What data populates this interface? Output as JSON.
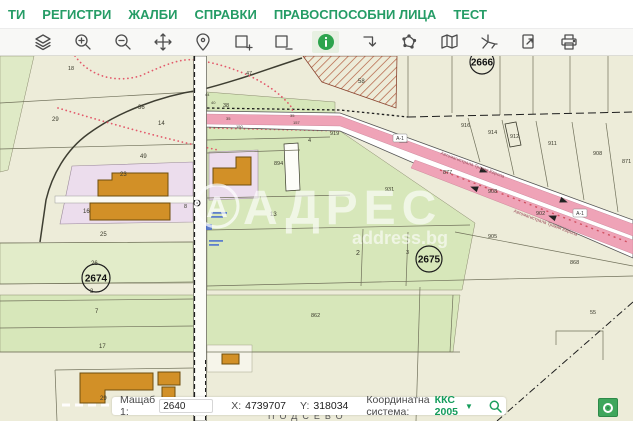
{
  "menu": {
    "items": [
      {
        "label": "ТИ"
      },
      {
        "label": "РЕГИСТРИ"
      },
      {
        "label": "ЖАЛБИ"
      },
      {
        "label": "СПРАВКИ"
      },
      {
        "label": "ПРАВОСПОСОБНИ ЛИЦА"
      },
      {
        "label": "ТЕСТ"
      }
    ]
  },
  "toolbar": {
    "icons": [
      "layers",
      "zoom-in",
      "zoom-out",
      "pan",
      "locate",
      "select-area-add",
      "select-area-subtract",
      "info",
      "measure-arrow",
      "polygon-select",
      "map-sheets",
      "snap-intersection",
      "export-document",
      "print"
    ],
    "active_tool": "info"
  },
  "map": {
    "watermark": {
      "logo_letter": "А",
      "brand": "АДРЕС",
      "site": "address.bg"
    },
    "highway": {
      "name": "Автомагистрала Тракия Европа",
      "shield": "А-1"
    },
    "area_label": "ПОДСЕВО",
    "circles": [
      {
        "text": "2666",
        "x": 482,
        "y": 6,
        "r": 12
      },
      {
        "text": "2674",
        "x": 96,
        "y": 222,
        "r": 14
      },
      {
        "text": "2675",
        "x": 429,
        "y": 203,
        "r": 13
      }
    ],
    "labels": [
      {
        "t": "18",
        "x": 68,
        "y": 14
      },
      {
        "t": "29",
        "x": 52,
        "y": 65,
        "s": 6
      },
      {
        "t": "36",
        "x": 138,
        "y": 53,
        "s": 6
      },
      {
        "t": "14",
        "x": 158,
        "y": 69,
        "s": 6
      },
      {
        "t": "49",
        "x": 140,
        "y": 102,
        "s": 6
      },
      {
        "t": "23",
        "x": 120,
        "y": 120,
        "s": 6
      },
      {
        "t": "16",
        "x": 83,
        "y": 157,
        "s": 6
      },
      {
        "t": "8",
        "x": 184,
        "y": 152
      },
      {
        "t": "25",
        "x": 100,
        "y": 180,
        "s": 6
      },
      {
        "t": "26",
        "x": 91,
        "y": 209,
        "s": 6
      },
      {
        "t": "3",
        "x": 90,
        "y": 237,
        "s": 6
      },
      {
        "t": "7",
        "x": 95,
        "y": 257,
        "s": 6
      },
      {
        "t": "17",
        "x": 99,
        "y": 292,
        "s": 6
      },
      {
        "t": "29",
        "x": 100,
        "y": 344,
        "s": 6
      },
      {
        "t": "47",
        "x": 246,
        "y": 19
      },
      {
        "t": "38",
        "x": 223,
        "y": 51
      },
      {
        "t": "44",
        "x": 205,
        "y": 40,
        "s": 4
      },
      {
        "t": "40",
        "x": 211,
        "y": 48,
        "s": 4
      },
      {
        "t": "35",
        "x": 226,
        "y": 64,
        "s": 4
      },
      {
        "t": "35",
        "x": 290,
        "y": 61,
        "s": 4
      },
      {
        "t": "150",
        "x": 236,
        "y": 72,
        "s": 4
      },
      {
        "t": "157",
        "x": 293,
        "y": 68,
        "s": 4
      },
      {
        "t": "919",
        "x": 330,
        "y": 79
      },
      {
        "t": "894",
        "x": 274,
        "y": 109
      },
      {
        "t": "4",
        "x": 308,
        "y": 86
      },
      {
        "t": "13",
        "x": 270,
        "y": 160,
        "s": 6
      },
      {
        "t": "2",
        "x": 356,
        "y": 199,
        "s": 7
      },
      {
        "t": "931",
        "x": 385,
        "y": 135
      },
      {
        "t": "58",
        "x": 358,
        "y": 27,
        "s": 6
      },
      {
        "t": "916",
        "x": 461,
        "y": 71
      },
      {
        "t": "914",
        "x": 488,
        "y": 78
      },
      {
        "t": "912",
        "x": 510,
        "y": 82
      },
      {
        "t": "911",
        "x": 548,
        "y": 89
      },
      {
        "t": "908",
        "x": 593,
        "y": 99
      },
      {
        "t": "871",
        "x": 622,
        "y": 107
      },
      {
        "t": "877",
        "x": 443,
        "y": 118
      },
      {
        "t": "908",
        "x": 488,
        "y": 137
      },
      {
        "t": "902",
        "x": 536,
        "y": 159
      },
      {
        "t": "905",
        "x": 488,
        "y": 182
      },
      {
        "t": "868",
        "x": 570,
        "y": 208
      },
      {
        "t": "862",
        "x": 311,
        "y": 261
      },
      {
        "t": "55",
        "x": 590,
        "y": 258
      },
      {
        "t": "3",
        "x": 406,
        "y": 198
      }
    ]
  },
  "statusbar": {
    "scale_label": "Мащаб 1:",
    "scale_value": "2640",
    "x_label": "X:",
    "x_value": "4739707",
    "y_label": "Y:",
    "y_value": "318034",
    "crs_label": "Координатна система:",
    "crs_value": "ККС 2005"
  },
  "colors": {
    "accent_green": "#1d9e5e",
    "map_beige": "#edecd9",
    "map_green": "#d7e7ba",
    "parcel_pink": "#ecdded",
    "building_orange": "#d29027",
    "highway_pink": "#efa3b7",
    "dotted_red": "#e35a6b"
  }
}
